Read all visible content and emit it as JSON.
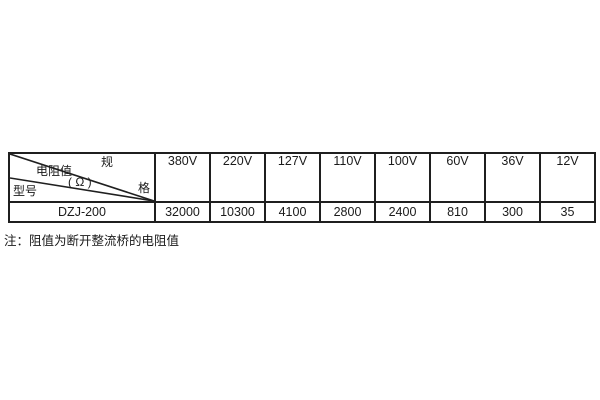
{
  "table": {
    "corner": {
      "spec_top_char": "规",
      "spec_bottom_char": "格",
      "resistance_label": "电阻值",
      "resistance_unit": "( Ω )",
      "model_label": "型号"
    },
    "columns": [
      "380V",
      "220V",
      "127V",
      "110V",
      "100V",
      "60V",
      "36V",
      "12V"
    ],
    "rows": [
      {
        "model": "DZJ-200",
        "values": [
          "32000",
          "10300",
          "4100",
          "2800",
          "2400",
          "810",
          "300",
          "35"
        ]
      }
    ]
  },
  "note": "注：阻值为断开整流桥的电阻值",
  "colors": {
    "border": "#1f1f1f",
    "text": "#1a1a1a",
    "background": "#ffffff"
  }
}
